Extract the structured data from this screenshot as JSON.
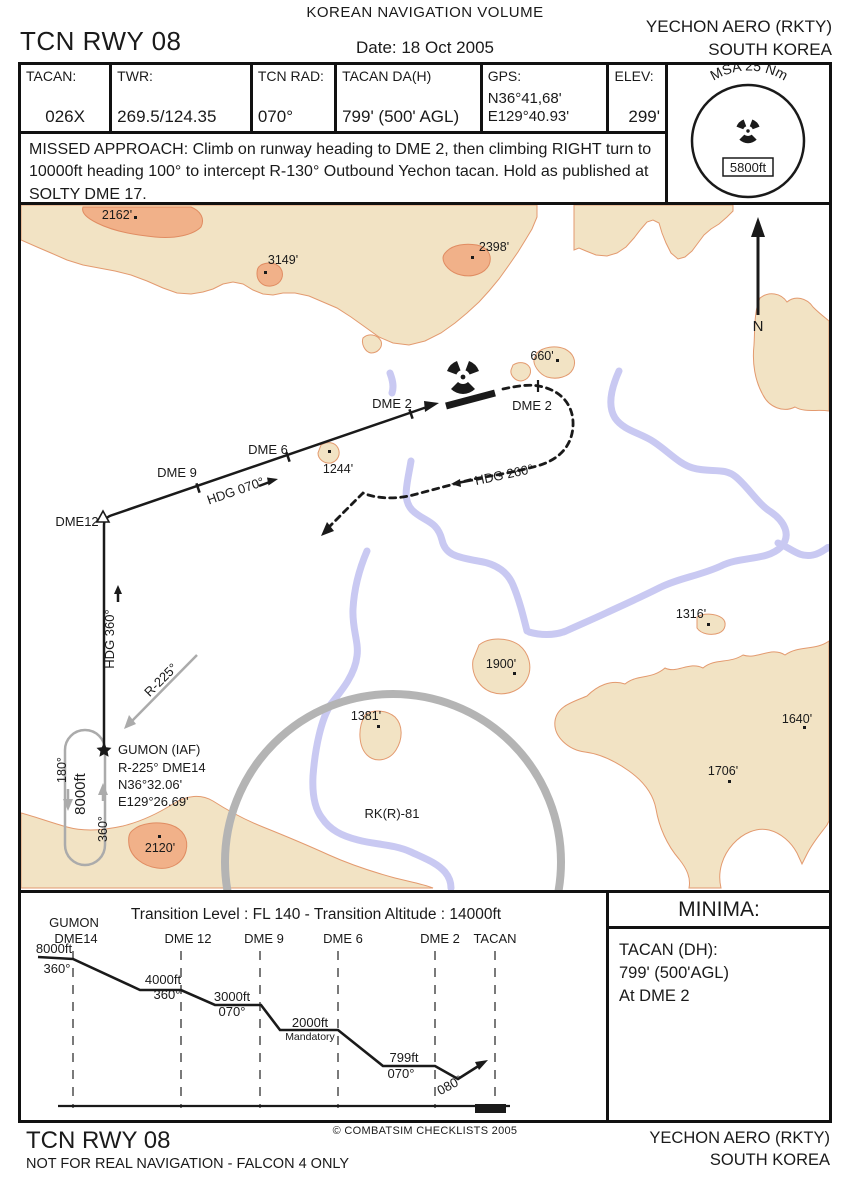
{
  "header": {
    "volume_title": "KOREAN NAVIGATION VOLUME",
    "procedure_title": "TCN RWY 08",
    "date": "Date: 18 Oct 2005",
    "airport_name": "YECHON AERO (RKTY)",
    "airport_country": "SOUTH KOREA"
  },
  "info_table": {
    "cells": [
      {
        "label": "TACAN:",
        "value": "026X"
      },
      {
        "label": "TWR:",
        "value": "269.5/124.35"
      },
      {
        "label": "TCN RAD:",
        "value": "070°"
      },
      {
        "label": "TACAN DA(H)",
        "value": "799' (500' AGL)"
      },
      {
        "label": "GPS:",
        "value": "N36°41,68'",
        "value2": "E129°40.93'"
      },
      {
        "label": "ELEV:",
        "value": "299'"
      }
    ]
  },
  "msa": {
    "arc_label": "MSA 25 Nm",
    "altitude": "5800ft"
  },
  "missed_approach_text": "MISSED APPROACH: Climb on runway heading to DME 2, then climbing RIGHT turn to 10000ft heading 100° to intercept R-130° Outbound Yechon tacan. Hold as published at SOLTY DME 17.",
  "map": {
    "north_label": "N",
    "restricted_area_label": "RK(R)-81",
    "spot_elevations": [
      "2162'",
      "3149'",
      "2398'",
      "660'",
      "1244'",
      "1316'",
      "1900'",
      "1381'",
      "1640'",
      "1706'",
      "2120'"
    ],
    "route": {
      "dme12": "DME12",
      "dme9": "DME 9",
      "dme6": "DME 6",
      "dme2_inbound": "DME 2",
      "dme2_missed": "DME 2",
      "hdg_inbound": "HDG 070°",
      "hdg_north": "HDG 360°",
      "hdg_missed": "HDG 260°",
      "radial": "R-225°"
    },
    "gumon": {
      "name": "GUMON (IAF)",
      "fix": "R-225° DME14",
      "lat": "N36°32.06'",
      "lon": "E129°26.69'"
    },
    "holding": {
      "outbound_hdg": "180°",
      "altitude": "8000ft",
      "inbound_hdg": "360°"
    }
  },
  "profile": {
    "title": "Transition Level : FL 140  -  Transition Altitude : 14000ft",
    "fixes": [
      "GUMON",
      "DME14",
      "DME 12",
      "DME 9",
      "DME 6",
      "DME 2",
      "TACAN"
    ],
    "steps": [
      {
        "alt": "8000ft",
        "hdg": "360°"
      },
      {
        "alt": "4000ft",
        "hdg": "360°"
      },
      {
        "alt": "3000ft",
        "hdg": "070°"
      },
      {
        "alt": "2000ft",
        "note": "Mandatory"
      },
      {
        "alt": "799ft",
        "hdg": "070°"
      },
      {
        "hdg": "080°"
      }
    ]
  },
  "minima": {
    "title": "MINIMA:",
    "line1": "TACAN (DH):",
    "line2": "799' (500'AGL)",
    "line3": "At DME 2"
  },
  "footer": {
    "procedure_title": "TCN RWY 08",
    "disclaimer": "NOT FOR REAL NAVIGATION - FALCON 4 ONLY",
    "copyright": "© COMBATSIM CHECKLISTS 2005",
    "airport_name": "YECHON AERO (RKTY)",
    "airport_country": "SOUTH KOREA"
  }
}
